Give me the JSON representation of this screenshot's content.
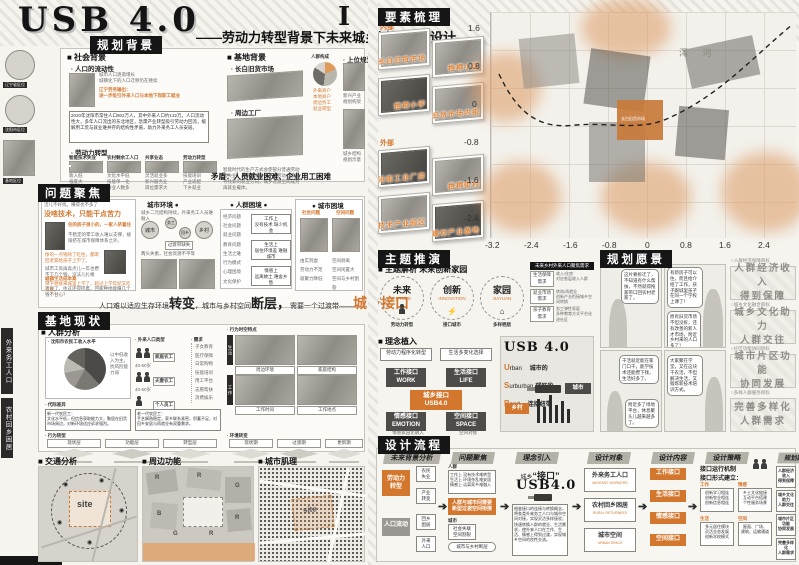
{
  "accent": "#d4772e",
  "header": {
    "title": "USB 4.0",
    "subtitle": "——劳动力转型背景下未来城乡过渡空间设计",
    "numeral": "I"
  },
  "margin": {
    "cap1": "辽宁省区位",
    "cap2": "沈阳市区位",
    "cap3": "基地区位",
    "tab1": "外来务工人口",
    "tab2": "农村回乡困居"
  },
  "s1": {
    "title": "规划背景",
    "social_h": "■ 社会背景",
    "mob_h": "· 人口的流动性",
    "mob_note": "城市人口逐渐增长\n城镇化下的人口迁移仍在继续",
    "mob_hl": "辽宁劳务输出：\n进一步吸引外来人口与本地下岗职工就业",
    "mob_para": "2020年沈阳市常住人口902万人，其中外来人口约132万。人口流动性大，多年人口流出的东北地区，急需产业转型吸引劳动力回流，缓解用工荒与就业难并存的结构性矛盾，助力外来务工人员安居。",
    "labor_h": "· 劳动力转型",
    "g1t": "智能技术失业",
    "g1l": "收入低\n强度大\n重复性",
    "g2t": "农村剩余工人口",
    "g2l": "文化水平低\n技能单一化\n待业人数多",
    "g3t": "共享业态",
    "g3l": "灵活就业多\n新兴服务业\n岗位需求大",
    "g4t": "劳动力转型",
    "g4l": "技能培训\n产业适配\n下乡就业",
    "labor_note": "智能时代的生产方式会使部分普通劳动者失业，未来技术替代下，劳动力需要寻找新的就业方向，城乡过渡空间成为再就业载体。",
    "site_h": "■ 基地背景",
    "mkt_h": "· 长白旧货市场",
    "fac_h": "· 周边工厂",
    "pie_h": "人群构成",
    "pie_tags": "外来商户\n本地商户\n周边务工\n就业转型",
    "upper_h": "· 上位规划",
    "um1": "新兴产业规划构架",
    "um2": "城乡结构规划示意",
    "conflict": "矛盾：人员就业困难、企业用工困难"
  },
  "s2": {
    "title": "问题聚焦",
    "p0": "活儿不好找，赚得也不多了",
    "q1": "没啥技术，只能干点苦力",
    "hl1": "住的房子很小的，一家人挤着住",
    "p1": "不稳定的零工收入难以支撑，被排挤在城市保障体系之外。",
    "p2": "挣的一点钱除了吃住，都寄回老家给孩子上学了。",
    "p3": "城市工资再高点儿一年也攒不下几个钱，没法儿扎根儿！",
    "sum_h": "城镇生活成本高",
    "q5": "孩子想接来城里上学了，超过上学年纪又吃亏帮。",
    "q6": "活没了、住这还得挤着，回家种地能赚几个钱不甘心？",
    "env_h": "城市环境 ●",
    "env_note": "城乡二元结构持续，外来务工人员难融入",
    "c1": "城市",
    "c2": "务工",
    "c3": "回乡",
    "c4": "乡村",
    "c_note": "过渡带缺失",
    "env_note2": "两头失衡，社会资源不平等",
    "crowd_h": "● 人群困境 ●",
    "crowd_list": "经济问题\n社会问题\n就业问题\n教育问题\n生活之难\n行为模式\n心理困境\n文化保护",
    "r1": "工作上\n没有技术 缺少机会",
    "r2": "生活上\n居住环境差 难融城市",
    "r3": "情感上\n远离故土 难舍乡愁",
    "city_h": "● 城市困境",
    "ct1": "社会问题",
    "ct2": "空间问题",
    "cl1": "由实到虚\n劳动力不足\n吸聚力降低",
    "cl2": "空间剥离\n空间闲置大\n空间与乡村割裂",
    "k1": "人口难以适应生存环境",
    "k2": "转变",
    "k3": "，城市与乡村空间",
    "k4": "断层，",
    "k5": "需要一个过渡带——",
    "k6": "城乡接口"
  },
  "s3": {
    "title": "基地现状",
    "crowd_h": "■ 人群分析",
    "pie_t": "· 沈阳市农民工收入水平",
    "pie_note": "以中低收入为主，抗风险能力弱",
    "types_h": "· 外来人口类型",
    "t1": "家庭农工",
    "a1": "40-60岁",
    "t2": "夫妻农工",
    "a2": "40-60岁",
    "t3": "个人员工",
    "a3": "20-35岁",
    "need_h": "· 需求",
    "needs": "子女教育\n医疗保障\n日常购物\n技能培训\n用工平台\n志愿帮扶\n消费娱乐",
    "qual_h": "· 代际差异",
    "qual1": "新一代农民工：\n文化水平低，但信息获取能力大，聚居在旧货市场周边，对新环境适应诉求强烈。",
    "qual2": "老一代农民工：\n手艺娴熟稳定，家乡联系紧密，积蓄不足，对回乡安居与再就业有双重需求。",
    "st_h": "· 行为时空特点",
    "stv1": "生活",
    "stv2": "工作",
    "stc1": "周边环境",
    "stc2": "家庭结构",
    "stc3": "工作时间",
    "stc4": "工作地点",
    "beh_h": "· 行为转型",
    "bc1": "现状层",
    "bc2": "功能层",
    "bc3": "转型层",
    "env_h": "· 环境转变",
    "ec1": "现状期",
    "ec2": "过渡期",
    "ec3": "更新期",
    "traffic_h": "■ 交通分析",
    "func_h": "■ 周边功能",
    "fabric_h": "■ 城市肌理",
    "site": "site",
    "fl1": "R",
    "fl2": "R",
    "fl3": "G",
    "fl4": "B",
    "fl5": "R",
    "fl6": "G",
    "fl7": "R"
  },
  "s4": {
    "title": "要素梳理",
    "in_h": "内部",
    "out_h": "外部",
    "in1": "长白旧货市场",
    "in2": "梧桐小区",
    "in3": "梧桐小学",
    "in4": "旧货市场内街",
    "out1": "沿街工业厂房",
    "out2": "梧桐街村",
    "out3": "技术产业园区",
    "out4": "建材产业基地",
    "x1": "-3.2",
    "x2": "-2.4",
    "x3": "-1.6",
    "x4": "-0.8",
    "x5": "0",
    "x6": "0.8",
    "x7": "1.6",
    "x8": "2.4",
    "y1": "1.6",
    "y2": "0.8",
    "y3": "0",
    "y4": "-0.8",
    "y5": "-1.6",
    "y6": "-2.4",
    "river": "浑 河",
    "site_lab": "长白旧货市场"
  },
  "s5": {
    "title": "主题推演",
    "sub_h": "■ 主题解析 未来创新家园",
    "c1": "未来",
    "e1": "FUTURE",
    "d1": "劳动力转型",
    "c2": "创新",
    "e2": "INNOVATION",
    "d2": "接口城市",
    "c3": "家园",
    "e3": "JIAYUAN",
    "d3": "多样栖居",
    "tbl_h": "未来乡村外来人口聚焦需求",
    "tr1l": "生活保障需求",
    "tr1r": "收入/住房\n对应各层收入人群",
    "tr2l": "就业市场需求",
    "tr2r": "转岗/再就业\n创新产业衔接城乡空间转换",
    "tr3l": "孩子教育需求",
    "tr3r": "务工弹性家庭\n多种教育方式平台化进社区",
    "idea_h": "■ 理念植入",
    "ft1": "劳动力程序化转型",
    "ft2": "生活多变化选择",
    "fb1": "工作接口\nWORK",
    "fb2": "生活接口\nLIFE",
    "fc": "城乡接口\nUSB4.0",
    "fb3": "情感接口\nEMOTION",
    "fb4": "空间接口\nSPACE",
    "fn1": "情感家园化融入",
    "fn2": "空间对接",
    "usb_t": "USB 4.0",
    "u1a": "U",
    "u1b": "rban",
    "u1c": "城市的",
    "u2a": "S",
    "u2b": "urburban",
    "u2c": "郊区的",
    "u3a": "B",
    "u3b": "ond",
    "u3c": "连接纽带",
    "city": "城市",
    "country": "乡村"
  },
  "s6": {
    "title": "规划愿景",
    "b1": "这片要拆迁了，不知道有什么帮扶，不然就得拖家带口回农村老家了。",
    "b2": "有新房子可以住，而且给介绍了工作，孩子跟城里孩子在同一个学校上课了！",
    "b3": "原有旧货市场不但没拆，还有改善的新人才市场，附近乡村来的人口多了！",
    "b4": "干活就近能在家门口干，能学技术还能攒下钱，生活好多了。",
    "b5": "大家聚在学堂，又在这块干农活，不但解决生活，又锻炼新技术培训方式。",
    "b6": "附近多了绿地平台，休息聚头儿越来越多了。",
    "g1c": "○人群经济保障目标",
    "g1": "人群经济收入\n得到保障",
    "g2c": "○城乡文化融合目标",
    "g2": "城乡文化助力\n人群交往",
    "g3c": "○片区功能协同目标",
    "g3": "城市片区功能\n协同发展",
    "g4c": "○多样人群服务目标",
    "g4": "完善多样化\n人群需求"
  },
  "s7": {
    "title": "设计流程",
    "col1": "未来背景分析",
    "c1b1": "劳动力\n转型",
    "c1b2": "人口流动",
    "c1l1": "农民\n失业",
    "c1l2": "产业\n转变",
    "c1l3": "回乡\n困居",
    "c1l4": "外来\n人口",
    "col2": "问题聚焦",
    "c2t": "人群",
    "c2tl": "工作上 没有技术难转型\n生活上 环境杂乱难安居\n情感上 远离家乡难融入",
    "c2mid": "人群与城市间需要\n新型过渡空间衔接",
    "c2b": "城市",
    "c2bl": "社会失联\n空间割裂",
    "c2bn": "城市与乡村断层",
    "col3": "理念引入",
    "c3a": "城乡",
    "c3b": "“接口”",
    "c3c": "USB4.0",
    "c3p": "借鉴接口的连接与转换概念，将各类外来务工人口与城市空间对接，实现灵活多样接驳；快速转换人群的就业、生活需求，使外来人口在工作、生活、情感上得到过渡，实现城乡空间的良性交流。",
    "col4": "设计对象",
    "c4b1": "外来务工人口",
    "c4e1": "MIGRANT WORKERS",
    "c4b2": "农村回乡困居",
    "c4e2": "RURAL RETURNEES",
    "c4b3": "城市空间",
    "c4e3": "URBAN SPACE",
    "col5": "设计内容",
    "c5b1": "工作接口",
    "c5b2": "生活接口",
    "c5b3": "情感接口",
    "c5b4": "空间接口",
    "col6": "设计策略",
    "c6h1": "接口运行机制",
    "c6h2": "接口形式建立：",
    "c6t1": "工作",
    "c6l1": "创新学习相连\n创新农业相连\n创新信息相连",
    "c6t2": "情感",
    "c6l2": "乡土文化链接\n互动平台搭建\n个性服务场景",
    "c6t3": "生活",
    "c6l3": "多元居住模块\n灵活业态发展\n创新学校模式",
    "c6t4": "空间",
    "c6l4": "屋面、广场、\n建筑、运输通道",
    "col7": "规划愿景",
    "c7l1": "人群经济收入\n得到保障",
    "c7l2": "城乡文化助力\n人群交往",
    "c7l3": "城市片区功能\n协同发展",
    "c7l4": "完善多样化\n人群需求"
  }
}
